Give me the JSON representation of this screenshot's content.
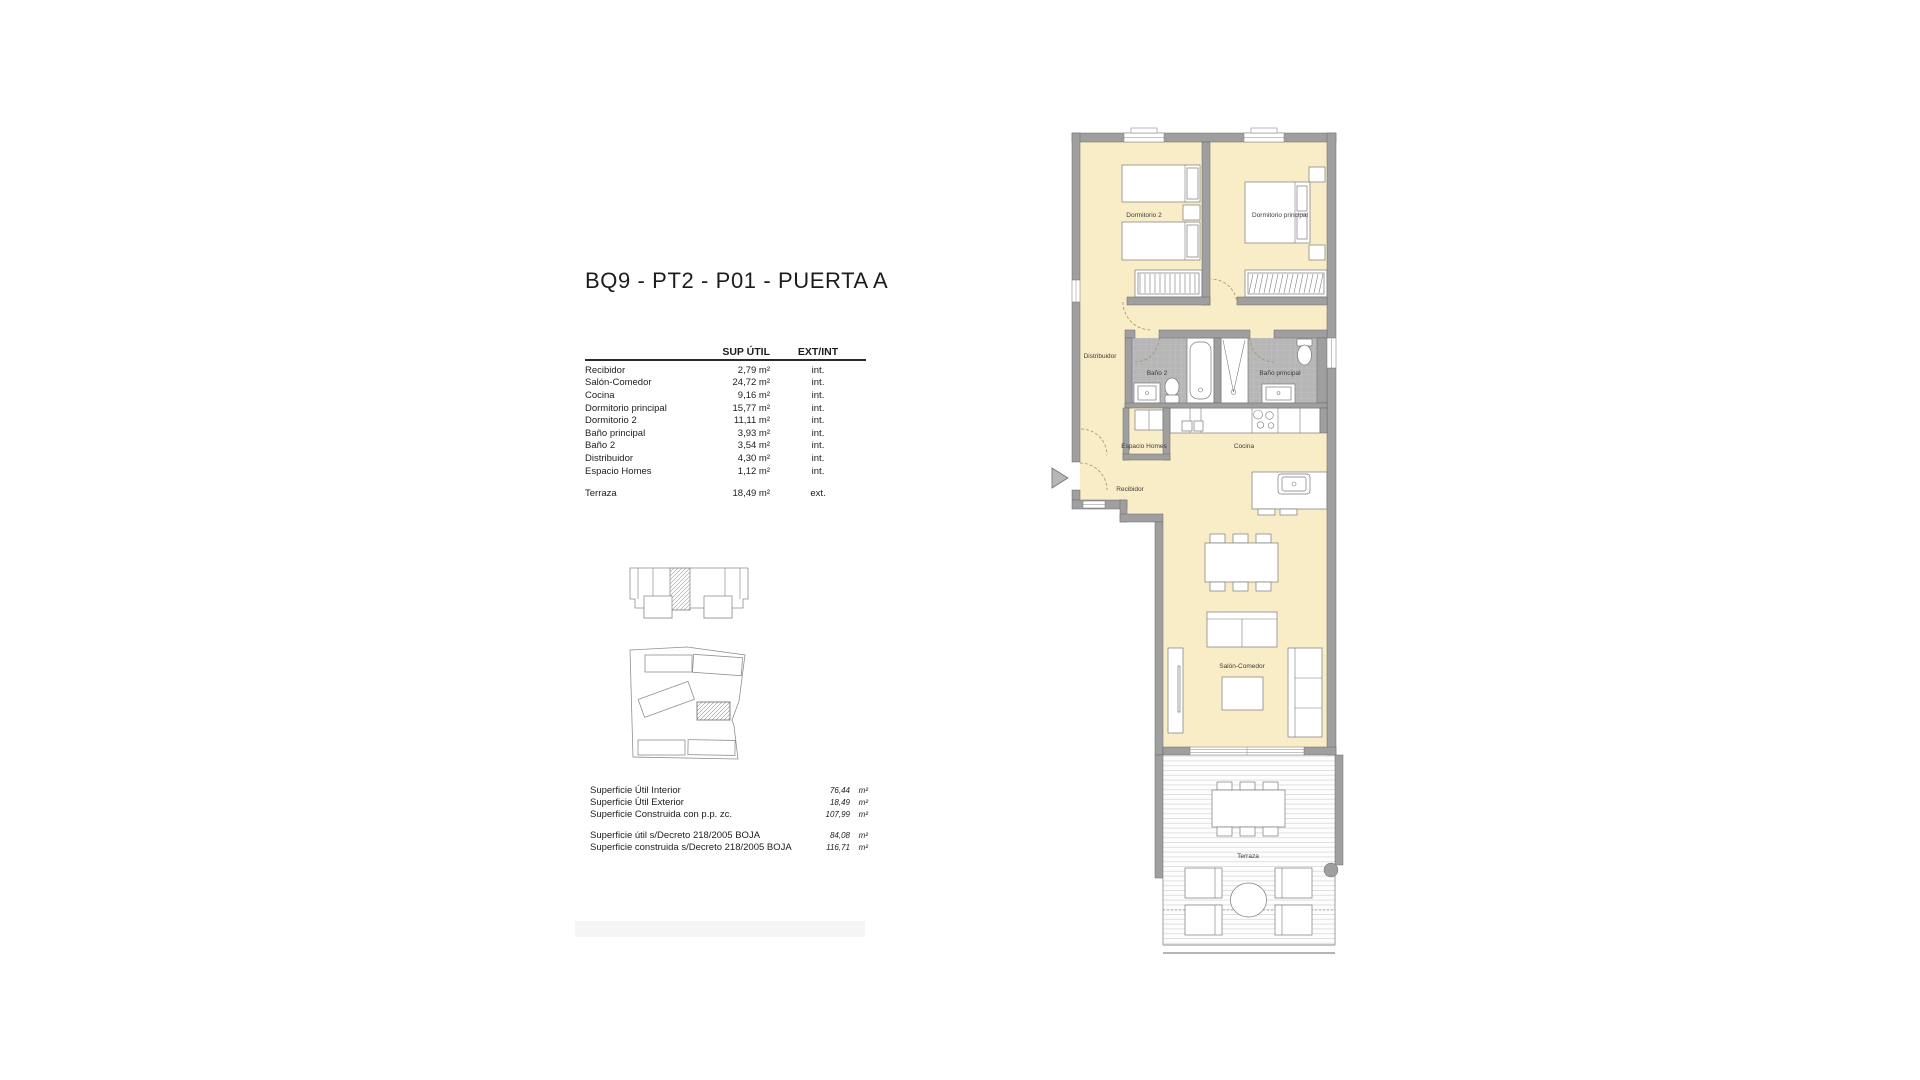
{
  "title": "BQ9 - PT2 - P01 - PUERTA A",
  "area_table": {
    "header": {
      "sup": "SUP ÚTIL",
      "ext": "EXT/INT"
    },
    "rows": [
      {
        "name": "Recibidor",
        "sup": "2,79 m²",
        "ext": "int."
      },
      {
        "name": "Salón-Comedor",
        "sup": "24,72 m²",
        "ext": "int."
      },
      {
        "name": "Cocina",
        "sup": "9,16 m²",
        "ext": "int."
      },
      {
        "name": "Dormitorio principal",
        "sup": "15,77 m²",
        "ext": "int."
      },
      {
        "name": "Dormitorio 2",
        "sup": "11,11 m²",
        "ext": "int."
      },
      {
        "name": "Baño principal",
        "sup": "3,93 m²",
        "ext": "int."
      },
      {
        "name": "Baño 2",
        "sup": "3,54 m²",
        "ext": "int."
      },
      {
        "name": "Distribuidor",
        "sup": "4,30 m²",
        "ext": "int."
      },
      {
        "name": "Espacio Homes",
        "sup": "1,12 m²",
        "ext": "int."
      }
    ],
    "terraza_row": {
      "name": "Terraza",
      "sup": "18,49 m²",
      "ext": "ext."
    }
  },
  "summary": {
    "rows": [
      {
        "label": "Superficie Útil Interior",
        "value": "76,44",
        "unit": "m²"
      },
      {
        "label": "Superficie Útil Exterior",
        "value": "18,49",
        "unit": "m²"
      },
      {
        "label": "Superficie Construida con p.p. zc.",
        "value": "107,99",
        "unit": "m²"
      }
    ],
    "decreto_rows": [
      {
        "label": "Superficie útil s/Decreto 218/2005 BOJA",
        "value": "84,08",
        "unit": "m²"
      },
      {
        "label": "Superficie construida s/Decreto 218/2005 BOJA",
        "value": "116,71",
        "unit": "m²"
      }
    ]
  },
  "plan": {
    "labels": {
      "dormitorio_2": "Dormitorio 2",
      "dormitorio_principal": "Dormitorio principal",
      "distribuidor": "Distribuidor",
      "bano_2": "Baño 2",
      "bano_principal": "Baño principal",
      "espacio_homes": "Espacio Homes",
      "cocina": "Cocina",
      "recibidor": "Recibidor",
      "salon_comedor": "Salón-Comedor",
      "terraza": "Terraza"
    }
  },
  "colors": {
    "floor": "#f9edc8",
    "wall": "#9f9f9f",
    "wall-stroke": "#686868",
    "tile": "#b6b6b6",
    "tile-grid": "#c9c9c9",
    "furniture-stroke": "#7a7a7a",
    "label": "#3b3b3b",
    "deck-line": "#d9d9d9",
    "door-arc": "#a5916b",
    "accent-bar": "#f5f5f5"
  }
}
